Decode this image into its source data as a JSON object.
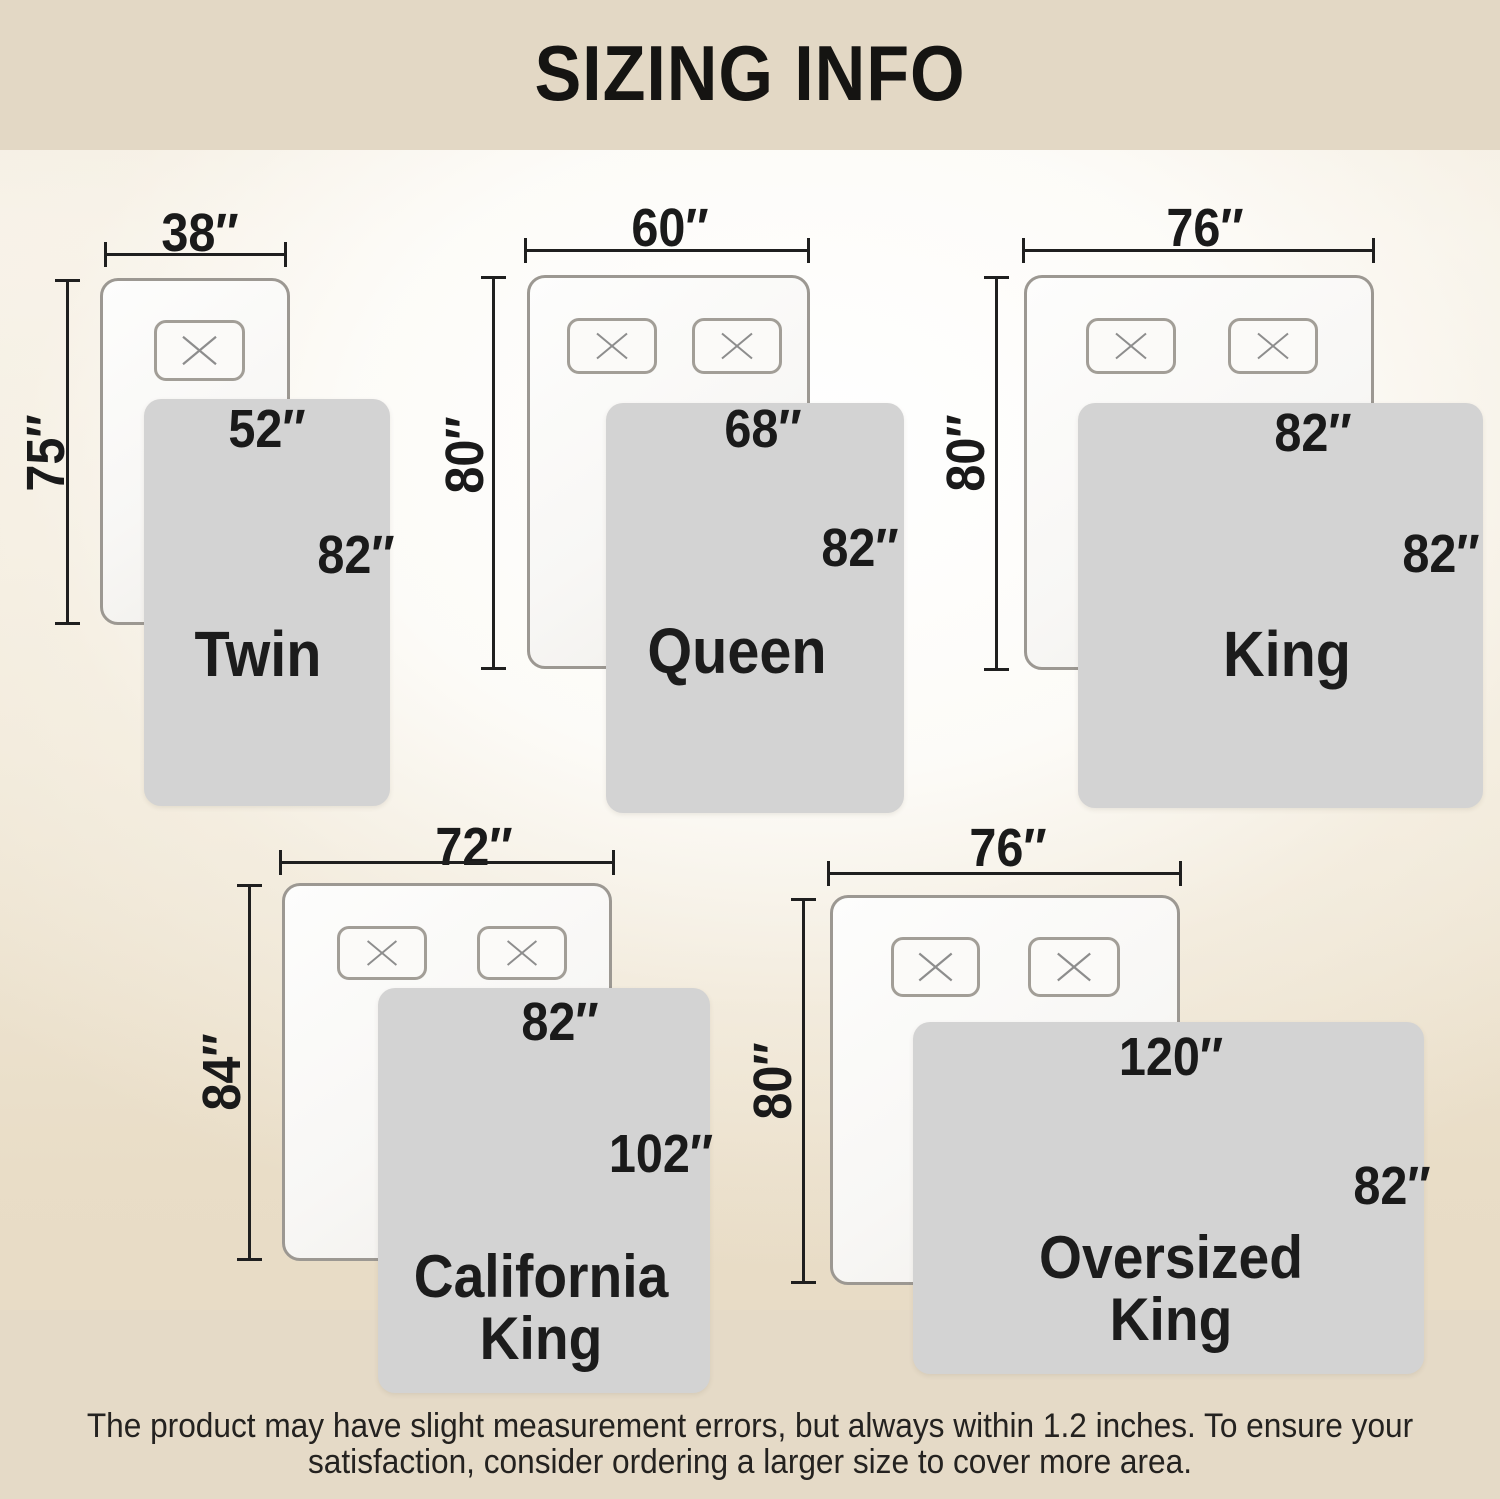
{
  "header": {
    "title": "SIZING INFO"
  },
  "sizes": [
    {
      "name": "Twin",
      "bed_width": "38″",
      "bed_length": "75″",
      "blanket_width": "52″",
      "blanket_length": "82″",
      "pillow_count": 1
    },
    {
      "name": "Queen",
      "bed_width": "60″",
      "bed_length": "80″",
      "blanket_width": "68″",
      "blanket_length": "82″",
      "pillow_count": 2
    },
    {
      "name": "King",
      "bed_width": "76″",
      "bed_length": "80″",
      "blanket_width": "82″",
      "blanket_length": "82″",
      "pillow_count": 2
    },
    {
      "name": "California King",
      "name_line1": "California",
      "name_line2": "King",
      "bed_width": "72″",
      "bed_length": "84″",
      "blanket_width": "82″",
      "blanket_length": "102″",
      "pillow_count": 2
    },
    {
      "name": "Oversized King",
      "name_line1": "Oversized",
      "name_line2": "King",
      "bed_width": "76″",
      "bed_length": "80″",
      "blanket_width": "120″",
      "blanket_length": "82″",
      "pillow_count": 2
    }
  ],
  "footer": {
    "line1": "The product may have slight measurement errors, but always within 1.2 inches. To ensure your",
    "line2": "satisfaction, consider ordering a larger size to cover more area."
  },
  "colors": {
    "band_beige": "#e3d8c5",
    "footer_beige": "#e5dac7",
    "blanket_gray": "#d3d3d3",
    "line_black": "#1f1f1f",
    "bed_border_gray": "#9c9892"
  }
}
